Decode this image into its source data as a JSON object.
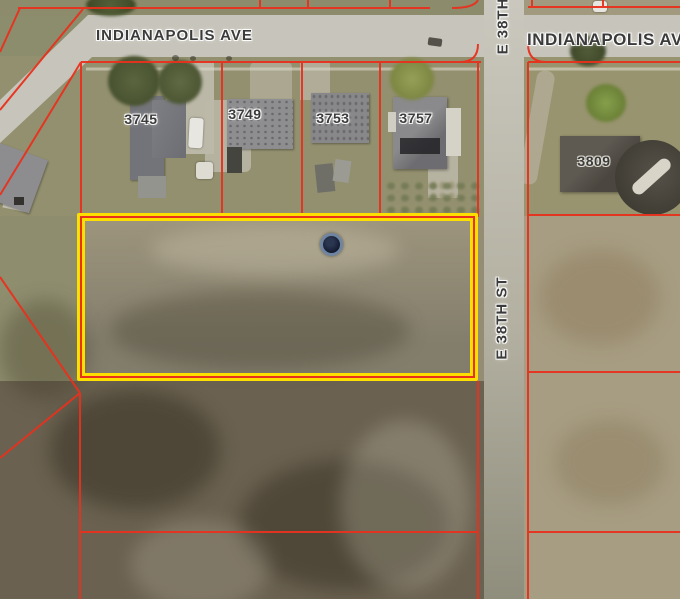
{
  "map": {
    "type": "aerial-parcel-map",
    "streets": {
      "indianapolis_ave_left": "INDIANAPOLIS AVE",
      "indianapolis_ave_right": "INDIANAPOLIS AVE",
      "e_38th_st_top": "E 38TH",
      "e_38th_st_mid": "E 38TH ST"
    },
    "house_numbers": [
      "3745",
      "3749",
      "3753",
      "3757",
      "3809"
    ],
    "highlighted_parcel": {
      "outline_color": "#ffdf00",
      "core_line_color": "#e8311d"
    },
    "colors": {
      "parcel_line": "#e8311d",
      "road": "#c7c5bb",
      "label_text": "#3b3b3b",
      "water_tower": "#141c30",
      "woods": "#6a6150",
      "lawn": "#93906f",
      "east_field": "#a79d82"
    }
  }
}
